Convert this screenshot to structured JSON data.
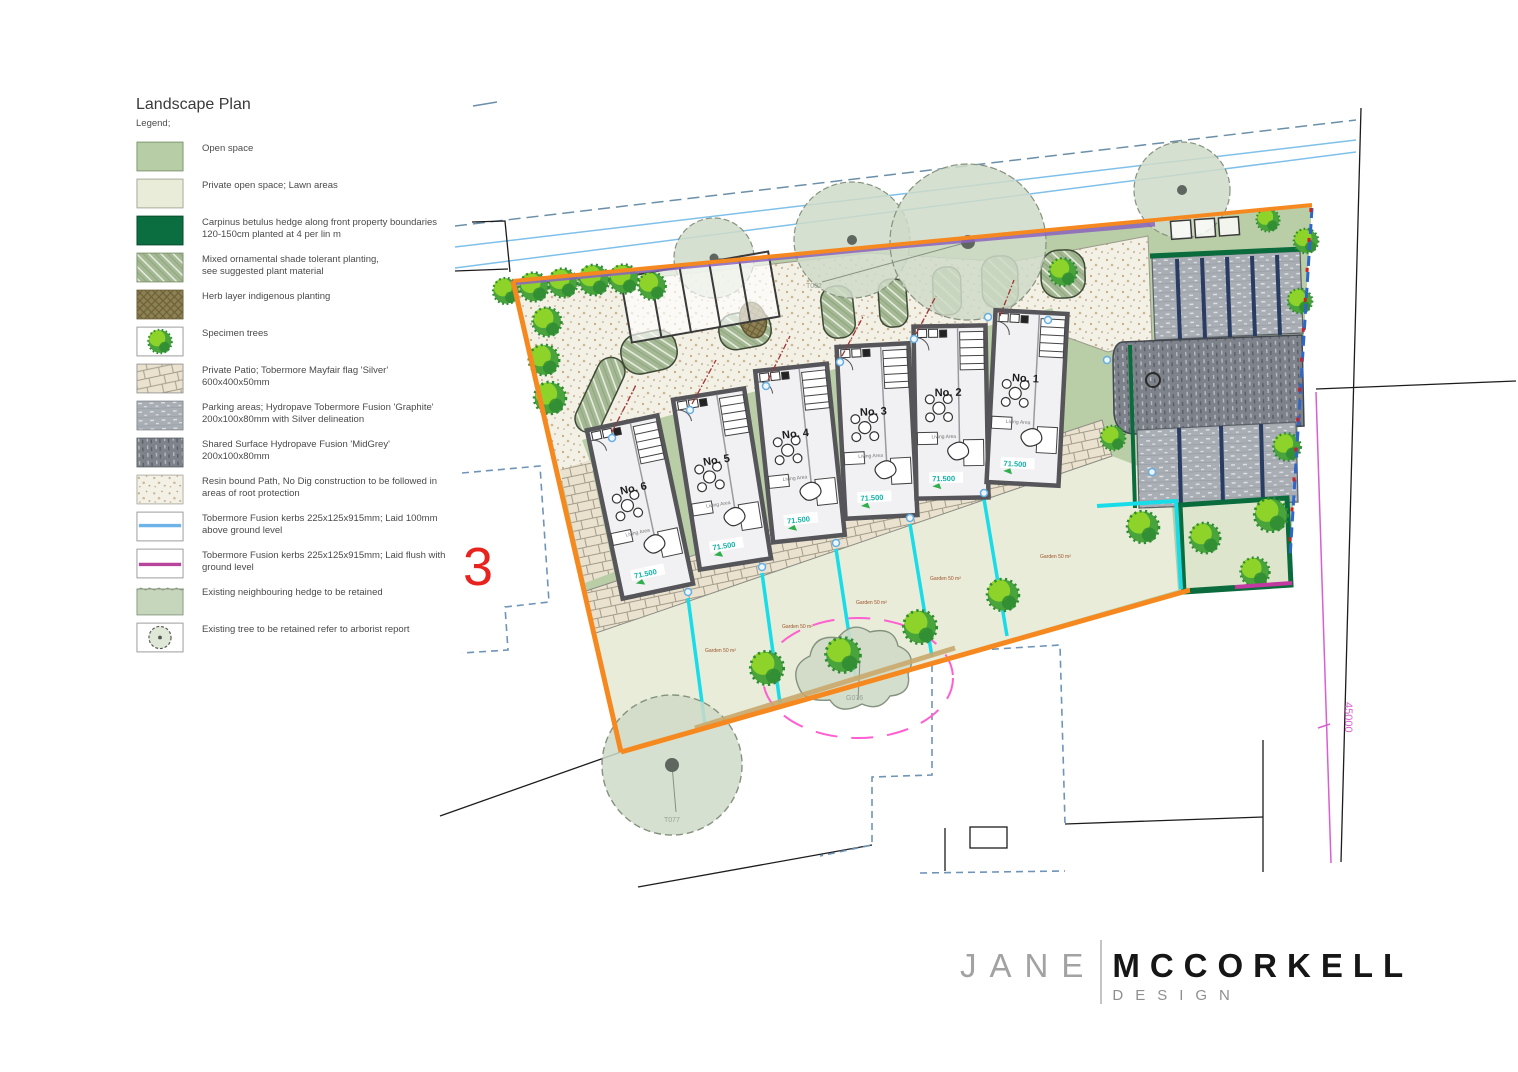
{
  "page": {
    "title": "Landscape Plan",
    "legend_heading": "Legend;"
  },
  "legend": {
    "items": [
      {
        "swatch": "open-space",
        "l1": "Open space",
        "l2": ""
      },
      {
        "swatch": "lawn",
        "l1": "Private open space; Lawn areas",
        "l2": ""
      },
      {
        "swatch": "hedge",
        "l1": "Carpinus betulus hedge along front property boundaries",
        "l2": "120-150cm planted at 4 per lin m"
      },
      {
        "swatch": "mixed",
        "l1": "Mixed ornamental shade tolerant planting,",
        "l2": "see suggested plant material"
      },
      {
        "swatch": "herb",
        "l1": "Herb layer indigenous planting",
        "l2": ""
      },
      {
        "swatch": "specimen",
        "l1": "Specimen trees",
        "l2": ""
      },
      {
        "swatch": "patio",
        "l1": "Private Patio; Tobermore Mayfair flag 'Silver'",
        "l2": "600x400x50mm"
      },
      {
        "swatch": "parking",
        "l1": "Parking areas; Hydropave Tobermore Fusion 'Graphite'",
        "l2": "200x100x80mm with Silver delineation"
      },
      {
        "swatch": "shared",
        "l1": "Shared Surface Hydropave Fusion 'MidGrey'",
        "l2": "200x100x80mm"
      },
      {
        "swatch": "resin",
        "l1": "Resin bound Path, No Dig construction to be followed in",
        "l2": "areas of root protection"
      },
      {
        "swatch": "kerb-raised",
        "l1": "Tobermore Fusion kerbs 225x125x915mm; Laid 100mm",
        "l2": "above ground level"
      },
      {
        "swatch": "kerb-flush",
        "l1": "Tobermore Fusion kerbs 225x125x915mm; Laid flush with",
        "l2": "ground level"
      },
      {
        "swatch": "hedge-existing",
        "l1": "Existing neighbouring hedge to be retained",
        "l2": ""
      },
      {
        "swatch": "tree-existing",
        "l1": "Existing tree to be retained refer to arborist report",
        "l2": ""
      }
    ]
  },
  "plan": {
    "houses": [
      {
        "label": "No. 6",
        "area": "Living Area",
        "level": "71.500"
      },
      {
        "label": "No. 5",
        "area": "Living Area",
        "level": "71.500"
      },
      {
        "label": "No. 4",
        "area": "Living Area",
        "level": "71.500"
      },
      {
        "label": "No. 3",
        "area": "Living Area",
        "level": "71.500"
      },
      {
        "label": "No. 2",
        "area": "Living Area",
        "level": "71.500"
      },
      {
        "label": "No. 1",
        "area": "Living Area",
        "level": "71.500"
      }
    ],
    "trees": [
      {
        "id": "T003"
      },
      {
        "id": "T002"
      },
      {
        "id": "T077"
      },
      {
        "id": "G076"
      }
    ],
    "garden_label": "Garden",
    "garden_area": "50 m²",
    "dimension": "45000",
    "neighbour_plot_number": "3"
  },
  "logo": {
    "first": "JANE",
    "last": "MCCORKELL",
    "sub": "DESIGN"
  },
  "colors": {
    "open_space": "#b9cda6",
    "lawn": "#e8ecd8",
    "hedge": "#0a6b3d",
    "boundary_orange": "#f5891f",
    "hedge_band_purple": "#8a63bd",
    "kerb_blue": "#5da4e0",
    "kerb_flush_magenta": "#b8459c",
    "divider_cyan": "#19dce9",
    "dimension_magenta": "#d95fd0",
    "plot_red": "#e8231d",
    "level_teal": "#0fb2a6"
  }
}
